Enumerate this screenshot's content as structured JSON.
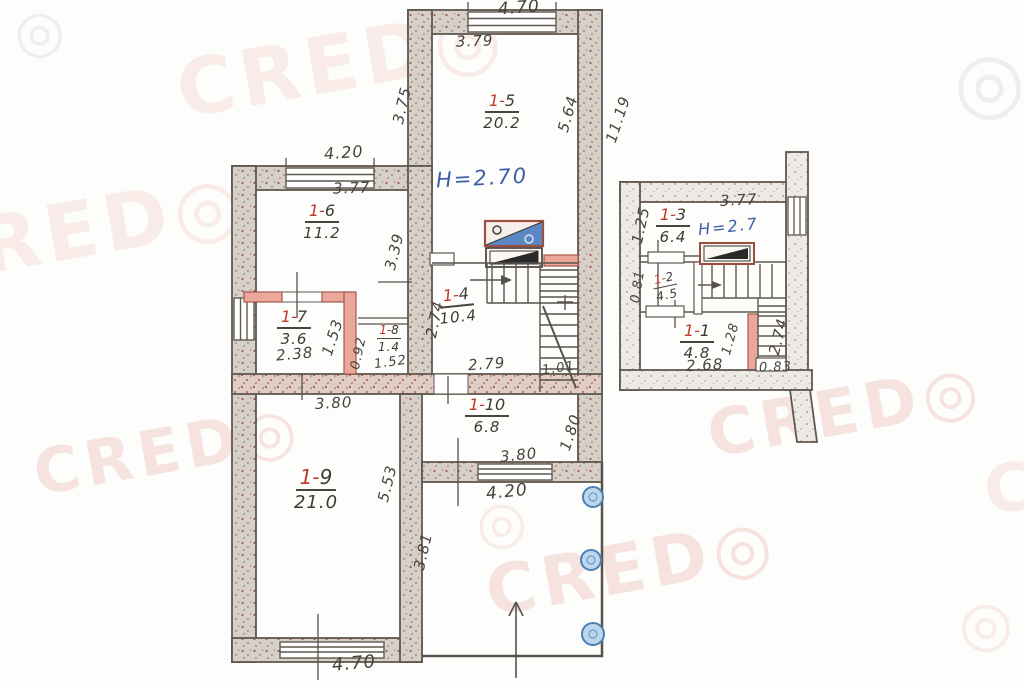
{
  "watermark": {
    "text": "CRED◎",
    "symbol": "◎"
  },
  "rooms": {
    "r5": {
      "prefix": "1-",
      "num": "5",
      "area": "20.2"
    },
    "r6": {
      "prefix": "1-",
      "num": "6",
      "area": "11.2"
    },
    "r7": {
      "prefix": "1-",
      "num": "7",
      "area": "3.6"
    },
    "r8": {
      "prefix": "1-",
      "num": "8",
      "area": "1.4"
    },
    "r4": {
      "prefix": "1-",
      "num": "4",
      "area": "10.4"
    },
    "r9": {
      "prefix": "1-",
      "num": "9",
      "area": "21.0"
    },
    "r10": {
      "prefix": "1-",
      "num": "10",
      "area": "6.8"
    },
    "r3": {
      "prefix": "1-",
      "num": "3",
      "area": "6.4"
    },
    "r2": {
      "prefix": "1-",
      "num": "2",
      "area": "4.5"
    },
    "r1": {
      "prefix": "1-",
      "num": "1",
      "area": "4.8"
    }
  },
  "heights": {
    "main": "H=2.70",
    "annex": "H=2.7"
  },
  "dims": {
    "top_470": "4.70",
    "top_379": "3.79",
    "left_375": "3.75",
    "right_564": "5.64",
    "right_1119": "11.19",
    "wing_420": "4.20",
    "wing_377": "3.77",
    "wing_339": "3.39",
    "r7_238": "2.38",
    "r7_153": "1.53",
    "r8_092": "0.92",
    "r8_152": "1.52",
    "r4_274": "2.74",
    "r4_279": "2.79",
    "stair_101": "1.01",
    "r9_380": "3.80",
    "r9_553": "5.53",
    "bottom_470": "4.70",
    "r10_180": "1.80",
    "r10_380": "3.80",
    "r10_420": "4.20",
    "porch_381": "3.81",
    "an_377": "3.77",
    "an_125": "1.25",
    "an_081": "0.81",
    "an_128": "1.28",
    "an_268": "2.68",
    "an_274": "2.74",
    "an_083": "0.83"
  },
  "colors": {
    "wall_line": "#5f584f",
    "partition_pink": "#eba89a",
    "label_red": "#c23a2c",
    "ink_blue": "#3c5fa6",
    "column_blue": "#bcd7ec",
    "watermark_pink": "#d66a5e"
  }
}
